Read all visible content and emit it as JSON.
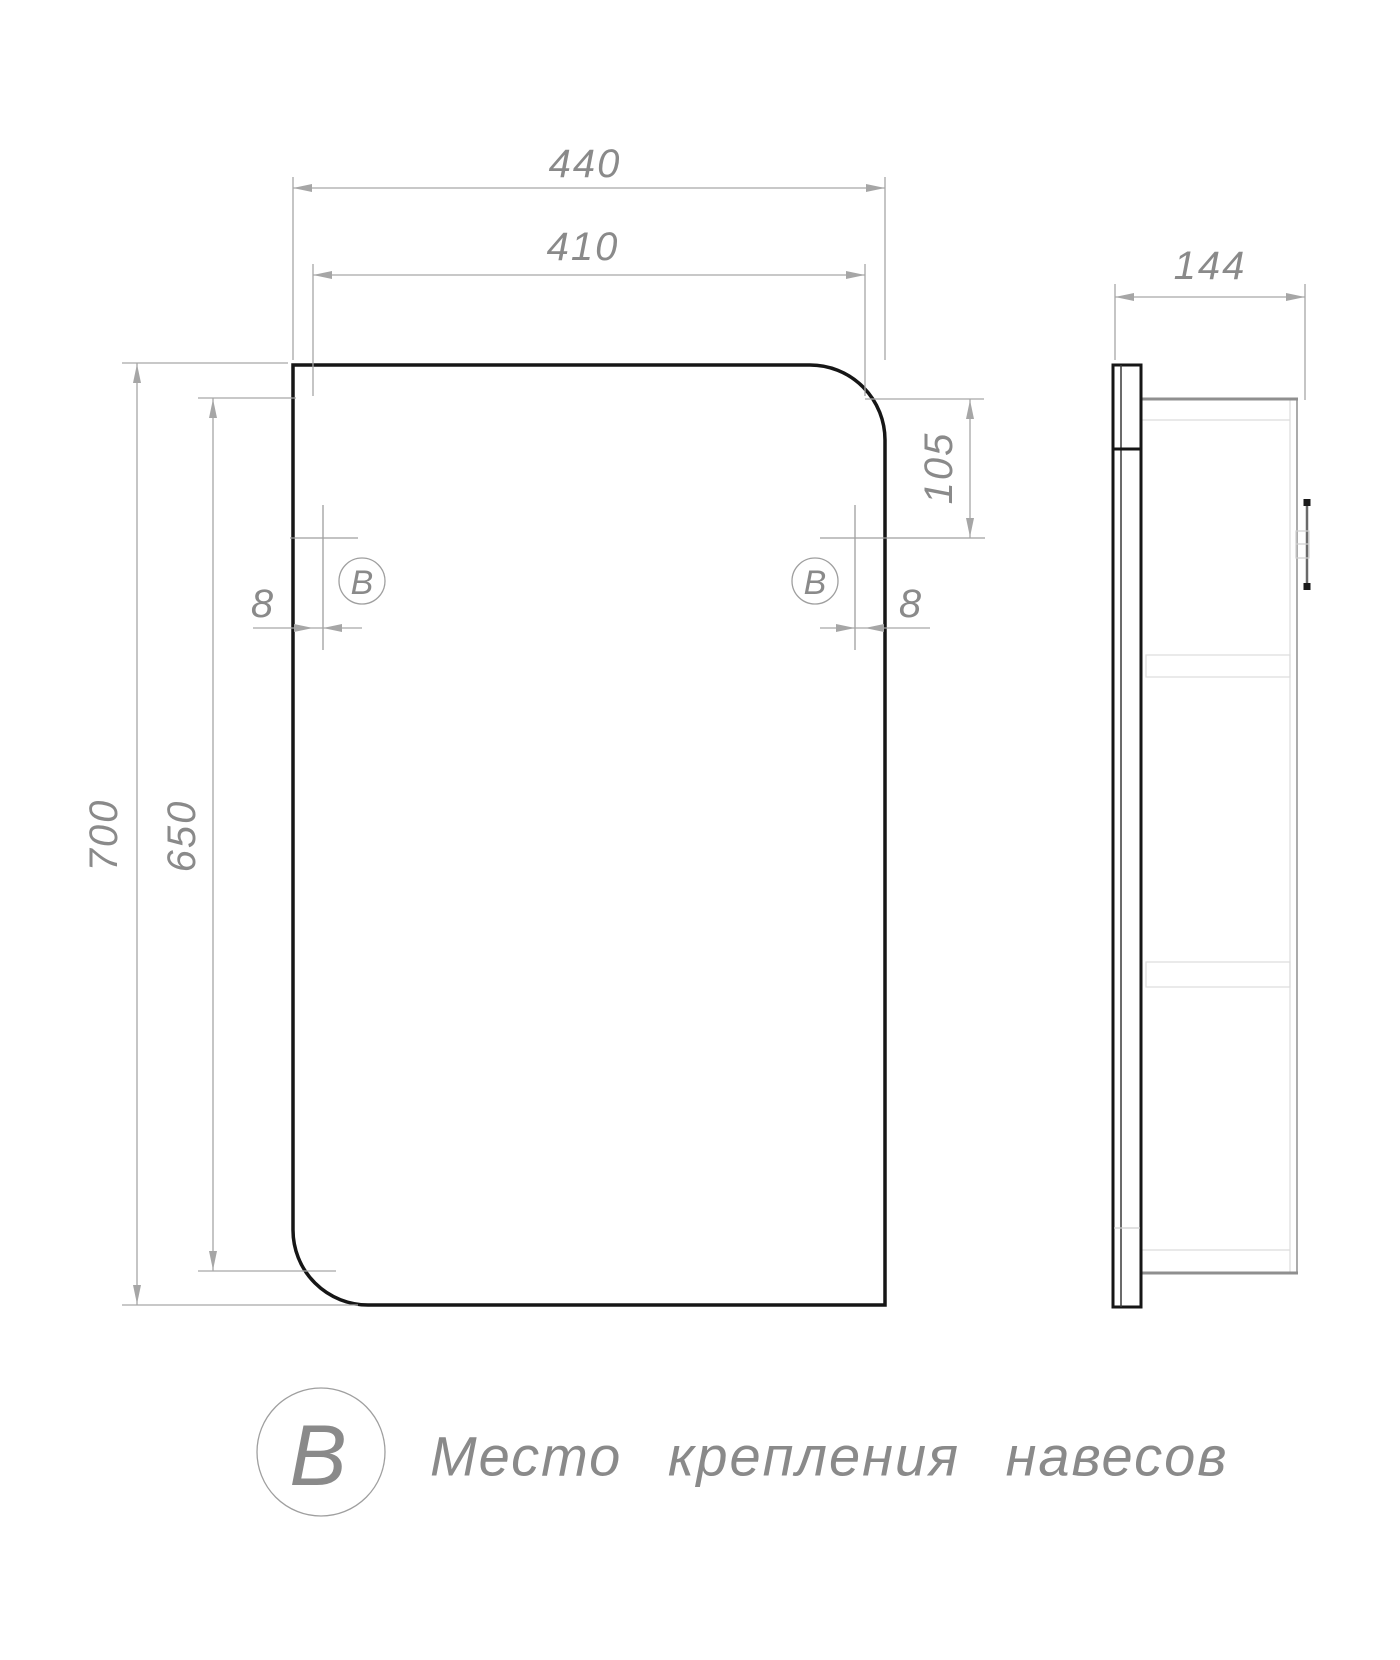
{
  "colors": {
    "background": "#ffffff",
    "outline": "#161616",
    "dim_lines": "#a6a6a6",
    "text": "#8a8a8a"
  },
  "front_view": {
    "dims": {
      "outer_width": "440",
      "mirror_width": "410",
      "outer_height": "700",
      "opening_height": "650",
      "mount_top_offset": "105",
      "mount_side_offset_left": "8",
      "mount_side_offset_right": "8"
    },
    "markers": {
      "left": "В",
      "right": "В"
    }
  },
  "side_view": {
    "dims": {
      "depth": "144"
    }
  },
  "legend": {
    "symbol": "В",
    "label": "Место крепления навесов"
  }
}
